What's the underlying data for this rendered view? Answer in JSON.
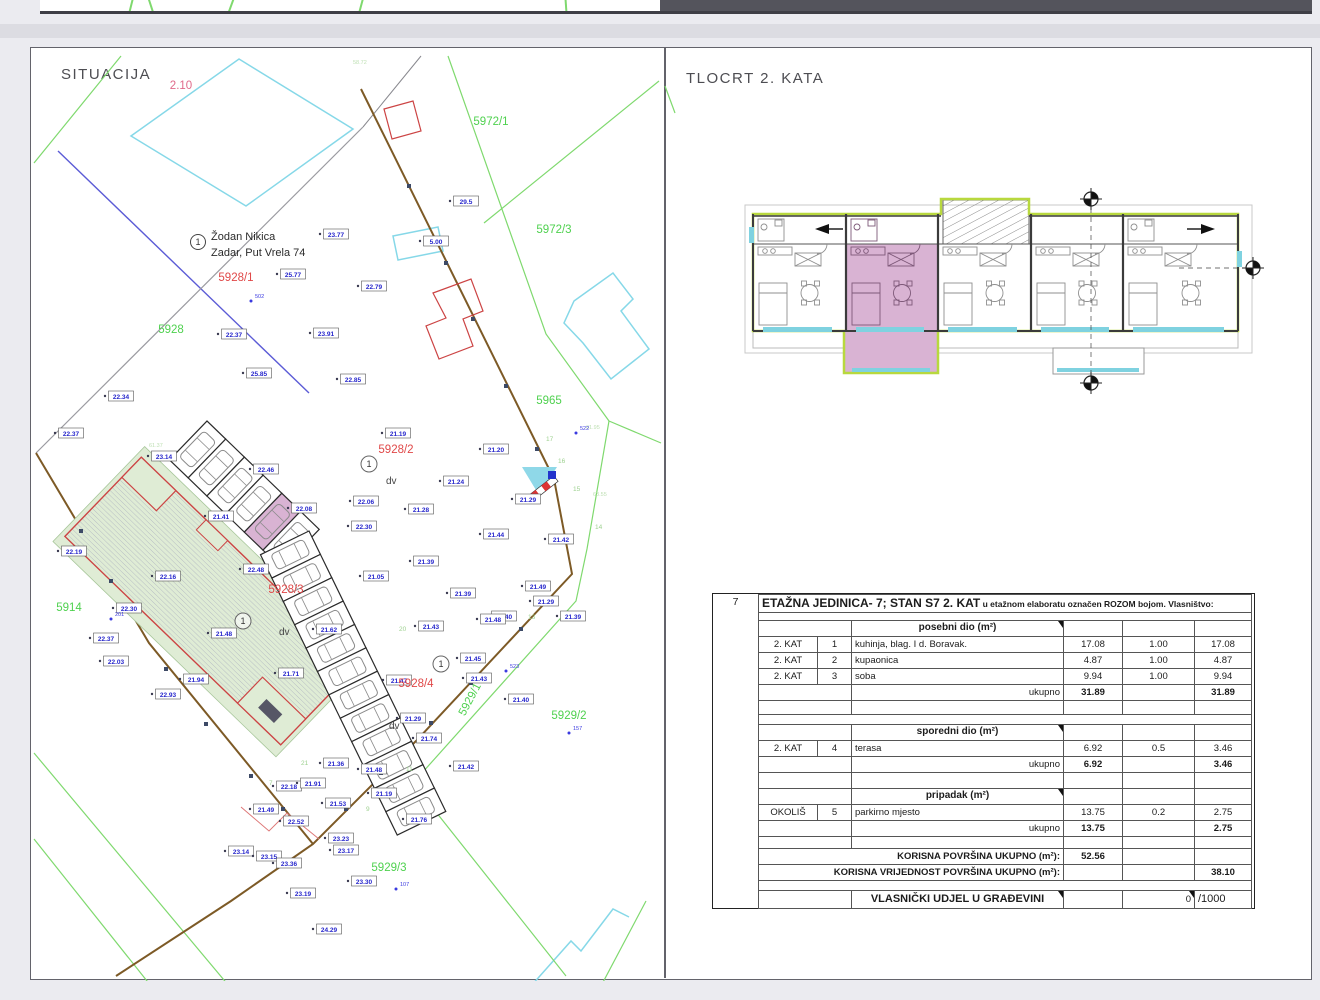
{
  "page": {
    "title_left": "SITUACIJA",
    "title_right": "TLOCRT 2.  KATA"
  },
  "colors": {
    "parcel_green": "#4fd14f",
    "parcel_red": "#e04848",
    "elevation_blue": "#2626cc",
    "point_blue": "#3a3ae0",
    "tick_green": "#9ed190",
    "faint_green": "#bfe0b4",
    "boundary_brown": "#7d5a26",
    "line_blue": "#5b5bd6",
    "cyan": "#86d8e8",
    "lime": "#b8d83e",
    "pink": "#d9b3d3",
    "yard_green": "#dfecd5",
    "hatch_red": "#cc4444"
  },
  "site_plan": {
    "owner": {
      "no": "1",
      "name": "Žodan Nikica",
      "addr": "Zadar, Put Vrela 74",
      "x": 197,
      "y": 241
    },
    "parcel_labels": [
      {
        "t": "5928/1",
        "x": 235,
        "y": 280,
        "c": "r"
      },
      {
        "t": "5928/2",
        "x": 395,
        "y": 452,
        "c": "r"
      },
      {
        "t": "5928/3",
        "x": 285,
        "y": 592,
        "c": "r"
      },
      {
        "t": "5928/4",
        "x": 415,
        "y": 686,
        "c": "r"
      },
      {
        "t": "5928",
        "x": 170,
        "y": 332,
        "c": "g"
      },
      {
        "t": "5914",
        "x": 68,
        "y": 610,
        "c": "g"
      },
      {
        "t": "5965",
        "x": 548,
        "y": 403,
        "c": "g"
      },
      {
        "t": "5972/1",
        "x": 490,
        "y": 124,
        "c": "g"
      },
      {
        "t": "5972/3",
        "x": 553,
        "y": 232,
        "c": "g"
      },
      {
        "t": "5929/2",
        "x": 568,
        "y": 718,
        "c": "g"
      },
      {
        "t": "5929/3",
        "x": 388,
        "y": 870,
        "c": "g"
      },
      {
        "t": "5929/1",
        "x": 472,
        "y": 700,
        "c": "g",
        "rot": -62
      },
      {
        "t": "2.10",
        "x": 180,
        "y": 88,
        "c": "p"
      }
    ],
    "dv_labels": [
      {
        "x": 385,
        "y": 483
      },
      {
        "x": 278,
        "y": 634
      },
      {
        "x": 388,
        "y": 728
      }
    ],
    "circle_markers": [
      {
        "x": 368,
        "y": 463
      },
      {
        "x": 242,
        "y": 620
      },
      {
        "x": 440,
        "y": 663
      }
    ],
    "points": [
      {
        "t": "502",
        "x": 250,
        "y": 300
      },
      {
        "t": "522",
        "x": 575,
        "y": 432
      },
      {
        "t": "523",
        "x": 505,
        "y": 670
      },
      {
        "t": "157",
        "x": 568,
        "y": 732
      },
      {
        "t": "107",
        "x": 395,
        "y": 888
      },
      {
        "t": "201",
        "x": 110,
        "y": 618
      }
    ],
    "tick_labels": [
      {
        "t": "17",
        "x": 545,
        "y": 440
      },
      {
        "t": "16",
        "x": 557,
        "y": 462
      },
      {
        "t": "15",
        "x": 572,
        "y": 490
      },
      {
        "t": "14",
        "x": 594,
        "y": 528
      },
      {
        "t": "13",
        "x": 527,
        "y": 618
      },
      {
        "t": "20",
        "x": 398,
        "y": 630
      },
      {
        "t": "21",
        "x": 300,
        "y": 764
      },
      {
        "t": "11",
        "x": 405,
        "y": 770
      },
      {
        "t": "9",
        "x": 365,
        "y": 810
      },
      {
        "t": "7",
        "x": 268,
        "y": 784
      }
    ],
    "faint_coords": [
      {
        "t": "58.72",
        "x": 352,
        "y": 63
      },
      {
        "t": "61.95",
        "x": 585,
        "y": 428
      },
      {
        "t": "63.55",
        "x": 592,
        "y": 495
      },
      {
        "t": "61.37",
        "x": 148,
        "y": 446
      }
    ],
    "elevations": [
      {
        "v": "23.77",
        "x": 335,
        "y": 233
      },
      {
        "v": "25.77",
        "x": 292,
        "y": 273
      },
      {
        "v": "22.79",
        "x": 373,
        "y": 285
      },
      {
        "v": "22.37",
        "x": 233,
        "y": 333
      },
      {
        "v": "23.91",
        "x": 325,
        "y": 332
      },
      {
        "v": "29.5",
        "x": 465,
        "y": 200
      },
      {
        "v": "5.00",
        "x": 435,
        "y": 240
      },
      {
        "v": "22.34",
        "x": 120,
        "y": 395
      },
      {
        "v": "22.37",
        "x": 70,
        "y": 432
      },
      {
        "v": "23.14",
        "x": 163,
        "y": 455
      },
      {
        "v": "25.85",
        "x": 258,
        "y": 372
      },
      {
        "v": "22.85",
        "x": 352,
        "y": 378
      },
      {
        "v": "21.19",
        "x": 397,
        "y": 432
      },
      {
        "v": "21.20",
        "x": 495,
        "y": 448
      },
      {
        "v": "21.24",
        "x": 455,
        "y": 480
      },
      {
        "v": "22.06",
        "x": 365,
        "y": 500
      },
      {
        "v": "21.28",
        "x": 420,
        "y": 508
      },
      {
        "v": "22.30",
        "x": 363,
        "y": 525
      },
      {
        "v": "21.29",
        "x": 527,
        "y": 498
      },
      {
        "v": "21.44",
        "x": 495,
        "y": 533
      },
      {
        "v": "21.42",
        "x": 560,
        "y": 538
      },
      {
        "v": "21.39",
        "x": 425,
        "y": 560
      },
      {
        "v": "21.05",
        "x": 375,
        "y": 575
      },
      {
        "v": "21.39",
        "x": 462,
        "y": 592
      },
      {
        "v": "21.49",
        "x": 537,
        "y": 585
      },
      {
        "v": "21.29",
        "x": 545,
        "y": 600
      },
      {
        "v": "21.40",
        "x": 503,
        "y": 615
      },
      {
        "v": "22.46",
        "x": 265,
        "y": 468
      },
      {
        "v": "21.41",
        "x": 220,
        "y": 515
      },
      {
        "v": "22.08",
        "x": 303,
        "y": 507
      },
      {
        "v": "22.48",
        "x": 255,
        "y": 568
      },
      {
        "v": "22.16",
        "x": 167,
        "y": 575
      },
      {
        "v": "22.19",
        "x": 73,
        "y": 550
      },
      {
        "v": "22.30",
        "x": 128,
        "y": 607
      },
      {
        "v": "22.37",
        "x": 105,
        "y": 637
      },
      {
        "v": "21.48",
        "x": 223,
        "y": 632
      },
      {
        "v": "22.03",
        "x": 115,
        "y": 660
      },
      {
        "v": "21.94",
        "x": 195,
        "y": 678
      },
      {
        "v": "22.93",
        "x": 167,
        "y": 693
      },
      {
        "v": "21.71",
        "x": 290,
        "y": 672
      },
      {
        "v": "21.62",
        "x": 328,
        "y": 628
      },
      {
        "v": "21.43",
        "x": 430,
        "y": 625
      },
      {
        "v": "21.48",
        "x": 492,
        "y": 618
      },
      {
        "v": "21.39",
        "x": 572,
        "y": 615
      },
      {
        "v": "21.45",
        "x": 472,
        "y": 657
      },
      {
        "v": "21.43",
        "x": 478,
        "y": 677
      },
      {
        "v": "21.40",
        "x": 520,
        "y": 698
      },
      {
        "v": "21.47",
        "x": 398,
        "y": 679
      },
      {
        "v": "21.29",
        "x": 412,
        "y": 717
      },
      {
        "v": "21.74",
        "x": 428,
        "y": 737
      },
      {
        "v": "21.42",
        "x": 465,
        "y": 765
      },
      {
        "v": "21.36",
        "x": 335,
        "y": 762
      },
      {
        "v": "21.48",
        "x": 373,
        "y": 768
      },
      {
        "v": "22.18",
        "x": 288,
        "y": 785
      },
      {
        "v": "21.91",
        "x": 312,
        "y": 782
      },
      {
        "v": "21.53",
        "x": 337,
        "y": 802
      },
      {
        "v": "21.19",
        "x": 383,
        "y": 792
      },
      {
        "v": "21.76",
        "x": 418,
        "y": 818
      },
      {
        "v": "21.49",
        "x": 265,
        "y": 808
      },
      {
        "v": "23.14",
        "x": 240,
        "y": 850
      },
      {
        "v": "23.15",
        "x": 268,
        "y": 855
      },
      {
        "v": "23.36",
        "x": 288,
        "y": 862
      },
      {
        "v": "23.23",
        "x": 340,
        "y": 837
      },
      {
        "v": "23.17",
        "x": 345,
        "y": 849
      },
      {
        "v": "22.52",
        "x": 295,
        "y": 820
      },
      {
        "v": "23.19",
        "x": 302,
        "y": 892
      },
      {
        "v": "23.30",
        "x": 363,
        "y": 880
      },
      {
        "v": "24.29",
        "x": 328,
        "y": 928
      }
    ]
  },
  "floor_plan": {
    "units": [
      {
        "x": 752,
        "w": 93
      },
      {
        "x": 845,
        "w": 92,
        "pink": true
      },
      {
        "x": 937,
        "w": 93
      },
      {
        "x": 1030,
        "w": 92
      },
      {
        "x": 1122,
        "w": 115
      }
    ]
  },
  "table": {
    "row_no": "7",
    "rows": [
      {
        "h": 18,
        "cells": [
          {
            "t": "ETAŽNA JEDINICA- 7; STAN S7 2. KAT",
            "t2": " u etažnom elaboratu označen ROZOM  bojom. Vlasništvo:",
            "cs": 6,
            "cl": "l ttl"
          }
        ]
      },
      {
        "h": 8,
        "cells": [
          {
            "t": "",
            "cs": 6
          }
        ]
      },
      {
        "h": 16,
        "cells": [
          {
            "t": "",
            "cs": 2
          },
          {
            "t": "posebni dio (m²)",
            "cl": "hd tri"
          },
          {
            "t": ""
          },
          {
            "t": ""
          },
          {
            "t": ""
          }
        ]
      },
      {
        "h": 16,
        "cells": [
          {
            "t": "2. KAT",
            "cl": "c"
          },
          {
            "t": "1",
            "cl": "c"
          },
          {
            "t": "kuhinja, blag. I d. Boravak.",
            "cl": "l"
          },
          {
            "t": "17.08",
            "cl": "c"
          },
          {
            "t": "1.00",
            "cl": "c"
          },
          {
            "t": "17.08",
            "cl": "c"
          }
        ]
      },
      {
        "h": 16,
        "cells": [
          {
            "t": "2. KAT",
            "cl": "c"
          },
          {
            "t": "2",
            "cl": "c"
          },
          {
            "t": "kupaonica",
            "cl": "l"
          },
          {
            "t": "4.87",
            "cl": "c"
          },
          {
            "t": "1.00",
            "cl": "c"
          },
          {
            "t": "4.87",
            "cl": "c"
          }
        ]
      },
      {
        "h": 16,
        "cells": [
          {
            "t": "2. KAT",
            "cl": "c"
          },
          {
            "t": "3",
            "cl": "c"
          },
          {
            "t": "soba",
            "cl": "l"
          },
          {
            "t": "9.94",
            "cl": "c"
          },
          {
            "t": "1.00",
            "cl": "c"
          },
          {
            "t": "9.94",
            "cl": "c"
          }
        ]
      },
      {
        "h": 16,
        "cells": [
          {
            "t": "",
            "cs": 2
          },
          {
            "t": "ukupno",
            "cl": "r"
          },
          {
            "t": "31.89",
            "cl": "c b"
          },
          {
            "t": ""
          },
          {
            "t": "31.89",
            "cl": "c b"
          }
        ]
      },
      {
        "h": 14,
        "cells": [
          {
            "t": "",
            "cs": 2
          },
          {
            "t": ""
          },
          {
            "t": ""
          },
          {
            "t": ""
          },
          {
            "t": ""
          }
        ]
      },
      {
        "h": 10,
        "cells": [
          {
            "t": "",
            "cs": 6
          }
        ]
      },
      {
        "h": 16,
        "cells": [
          {
            "t": "",
            "cs": 2
          },
          {
            "t": "sporedni dio (m²)",
            "cl": "hd tri"
          },
          {
            "t": ""
          },
          {
            "t": ""
          },
          {
            "t": ""
          }
        ]
      },
      {
        "h": 16,
        "cells": [
          {
            "t": "2. KAT",
            "cl": "c"
          },
          {
            "t": "4",
            "cl": "c"
          },
          {
            "t": "terasa",
            "cl": "l"
          },
          {
            "t": "6.92",
            "cl": "c"
          },
          {
            "t": "0.5",
            "cl": "c"
          },
          {
            "t": "3.46",
            "cl": "c"
          }
        ]
      },
      {
        "h": 16,
        "cells": [
          {
            "t": "",
            "cs": 2
          },
          {
            "t": "ukupno",
            "cl": "r"
          },
          {
            "t": "6.92",
            "cl": "c b"
          },
          {
            "t": ""
          },
          {
            "t": "3.46",
            "cl": "c b"
          }
        ]
      },
      {
        "h": 16,
        "cells": [
          {
            "t": "",
            "cs": 2
          },
          {
            "t": ""
          },
          {
            "t": ""
          },
          {
            "t": ""
          },
          {
            "t": ""
          }
        ]
      },
      {
        "h": 16,
        "cells": [
          {
            "t": "",
            "cs": 2
          },
          {
            "t": "pripadak (m²)",
            "cl": "hd tri"
          },
          {
            "t": ""
          },
          {
            "t": ""
          },
          {
            "t": ""
          }
        ]
      },
      {
        "h": 16,
        "cells": [
          {
            "t": "OKOLIŠ",
            "cl": "c"
          },
          {
            "t": "5",
            "cl": "c"
          },
          {
            "t": "parkirno mjesto",
            "cl": "l"
          },
          {
            "t": "13.75",
            "cl": "c"
          },
          {
            "t": "0.2",
            "cl": "c"
          },
          {
            "t": "2.75",
            "cl": "c"
          }
        ]
      },
      {
        "h": 16,
        "cells": [
          {
            "t": "",
            "cs": 2
          },
          {
            "t": "ukupno",
            "cl": "r"
          },
          {
            "t": "13.75",
            "cl": "c b"
          },
          {
            "t": ""
          },
          {
            "t": "2.75",
            "cl": "c b"
          }
        ]
      },
      {
        "h": 12,
        "cells": [
          {
            "t": "",
            "cs": 2
          },
          {
            "t": ""
          },
          {
            "t": ""
          },
          {
            "t": ""
          },
          {
            "t": ""
          }
        ]
      },
      {
        "h": 16,
        "cells": [
          {
            "t": "KORISNA POVRŠINA UKUPNO (m²):",
            "cs": 3,
            "cl": "r b"
          },
          {
            "t": "52.56",
            "cl": "c b"
          },
          {
            "t": ""
          },
          {
            "t": ""
          }
        ]
      },
      {
        "h": 16,
        "cells": [
          {
            "t": "KORISNA VRIJEDNOST POVRŠINA UKUPNO (m²):",
            "cs": 3,
            "cl": "r b"
          },
          {
            "t": ""
          },
          {
            "t": ""
          },
          {
            "t": "38.10",
            "cl": "c b"
          }
        ]
      },
      {
        "h": 10,
        "cells": [
          {
            "t": "",
            "cs": 6
          }
        ]
      },
      {
        "h": 18,
        "cells": [
          {
            "t": "",
            "cs": 2
          },
          {
            "t": "VLASNIČKI UDJEL U GRAĐEVINI",
            "cl": "c b vl tri"
          },
          {
            "t": ""
          },
          {
            "t": "0",
            "cl": "r tri"
          },
          {
            "t": "/1000",
            "cl": "l vl"
          }
        ]
      }
    ]
  }
}
